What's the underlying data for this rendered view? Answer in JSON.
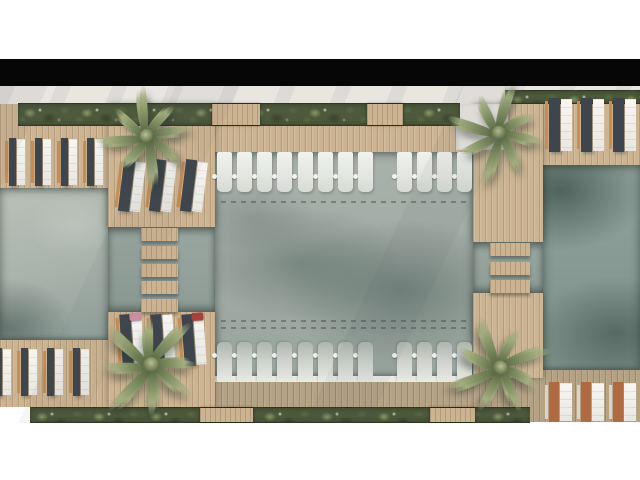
{
  "meta": {
    "description": "Top-down architectural rendering of a resort swimming pool area with wooden decks, jetty bridges, rows of sun loungers, planter strips and four palm trees",
    "view": "plan view, letterboxed"
  },
  "palette": {
    "white_bg": "#ffffff",
    "letterbox": "#060606",
    "sand": "#e9e6e0",
    "wood": "#ccb492",
    "wood_shaded": "#b5a285",
    "orange_wood": "#c98d52",
    "rust": "#b06a42",
    "lounger_gray": "#3f454c",
    "green_dark": "#38422d",
    "green_mid": "#5a6a44",
    "green_light": "#8c9868",
    "palm_light": "#a3ad7f",
    "palm_dark": "#6f7f55",
    "towel_pink": "#c98fa0",
    "towel_red": "#a8403c"
  },
  "scene": {
    "pools": [
      "left",
      "central",
      "right"
    ],
    "pool_lounger_rows": [
      {
        "id": "top",
        "groups": [
          8,
          4
        ],
        "side_tables": true
      },
      {
        "id": "bottom",
        "groups": [
          8,
          4
        ],
        "side_tables": true
      }
    ],
    "deck_lounger_rows": [
      {
        "id": "top-left-deck",
        "loungers": 4
      },
      {
        "id": "top-left-platform",
        "loungers": 3
      },
      {
        "id": "top-right-deck",
        "loungers": 3
      },
      {
        "id": "bottom-left-deck",
        "loungers": 4
      },
      {
        "id": "bottom-left-platform",
        "loungers": 3,
        "towels": [
          "pink",
          null,
          "red"
        ]
      },
      {
        "id": "bottom-right-deck",
        "loungers": 3
      }
    ],
    "bridges": [
      {
        "id": "left",
        "slats": 5
      },
      {
        "id": "right",
        "slats": 3
      }
    ],
    "palms": {
      "count": 4,
      "fronds": 16,
      "positions": [
        "top-left",
        "top-right",
        "bottom-left",
        "bottom-right"
      ]
    },
    "planters": {
      "top_wood_boxes": 2,
      "bottom_wood_boxes": 2
    }
  }
}
